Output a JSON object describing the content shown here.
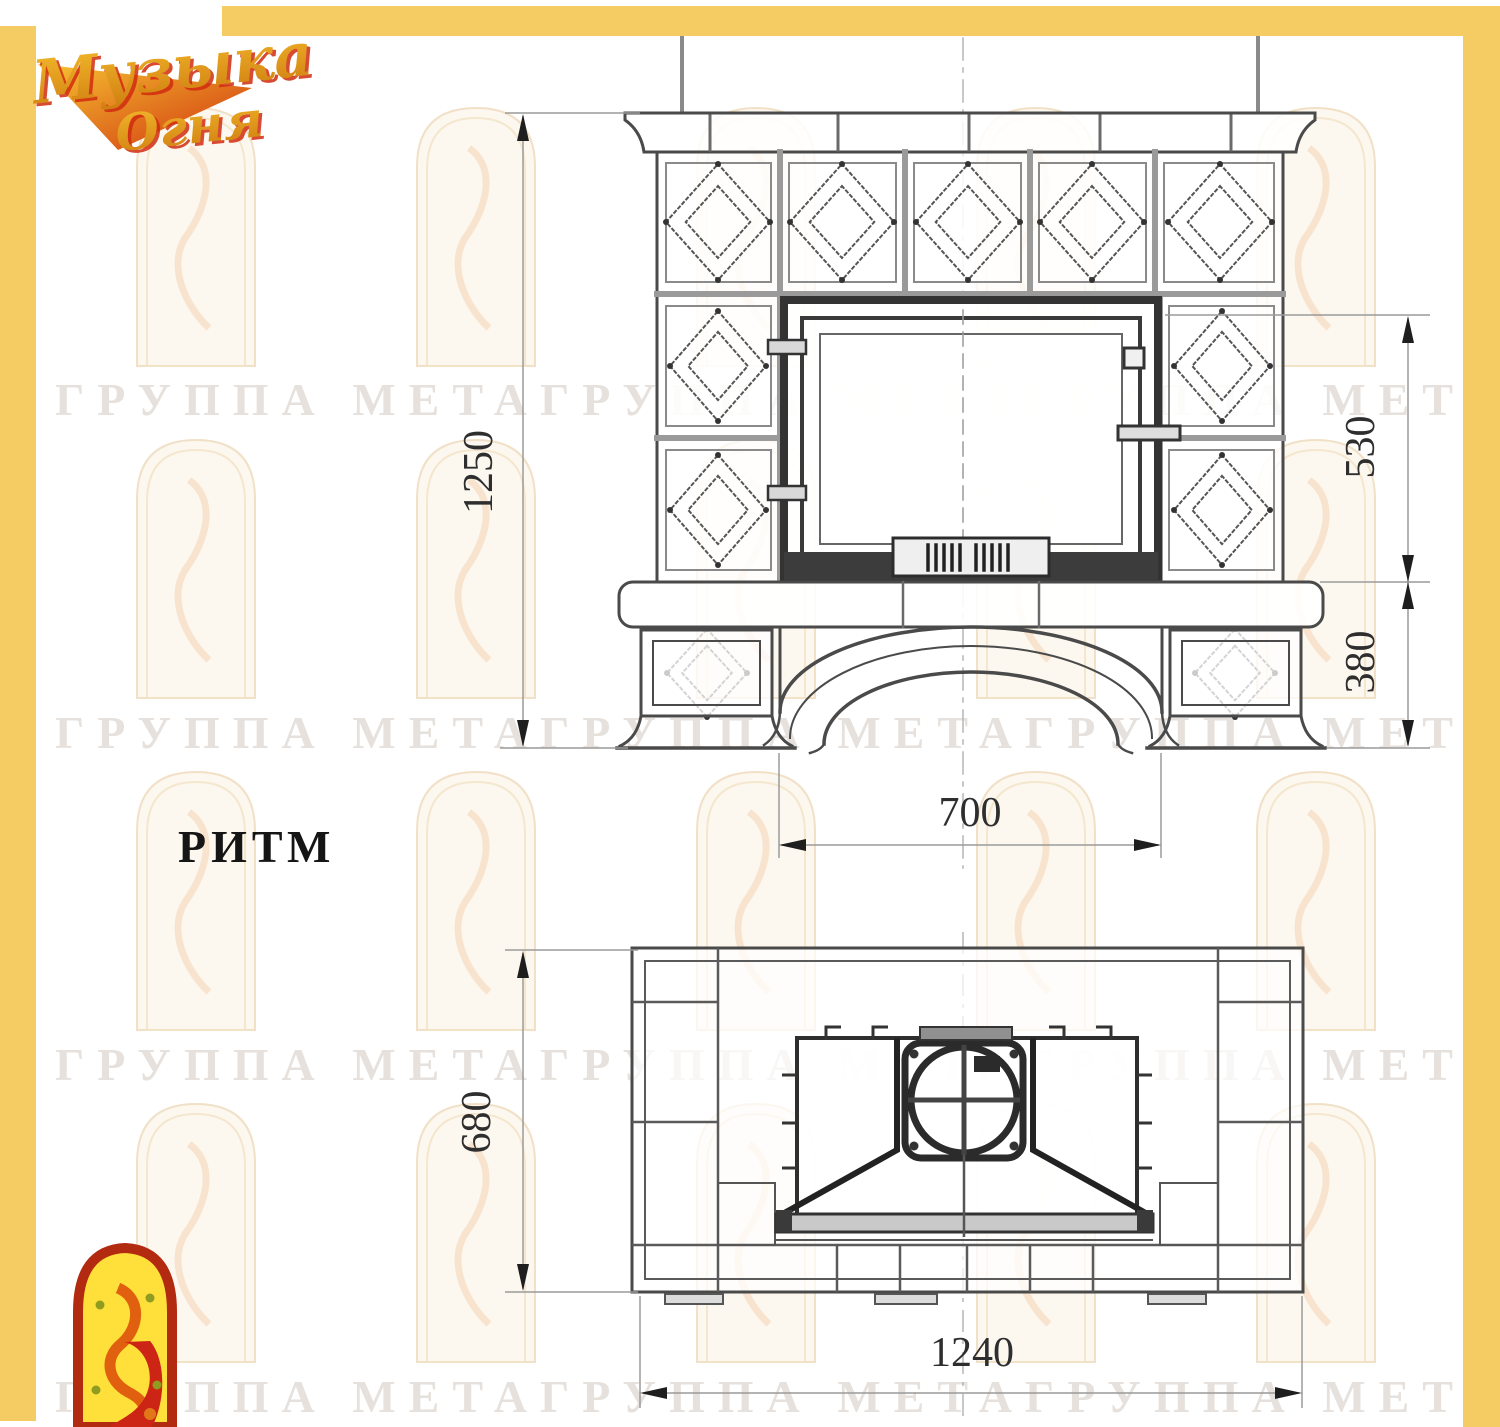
{
  "branding": {
    "logo_word1": "Музыка",
    "logo_word2": "Огня"
  },
  "sheet": {
    "model_label": "РИТМ",
    "watermark_text": "ГРУППА МЕТАГРУППА МЕТАГРУППА МЕТА"
  },
  "front_view": {
    "dim_total_height": "1250",
    "dim_firebox_height": "530",
    "dim_base_height": "380",
    "dim_opening_width": "700"
  },
  "plan_view": {
    "dim_depth": "680",
    "dim_width": "1240"
  },
  "colors": {
    "frame_yellow": "#f4cc63",
    "logo_gold": "#e09a18",
    "logo_red": "#d22c10",
    "icon_fill_yellow": "#ffdf3a",
    "icon_border_red": "#b22a10",
    "drawing_line": "#4a4a4a",
    "dimension_text": "#2e2e2e"
  }
}
